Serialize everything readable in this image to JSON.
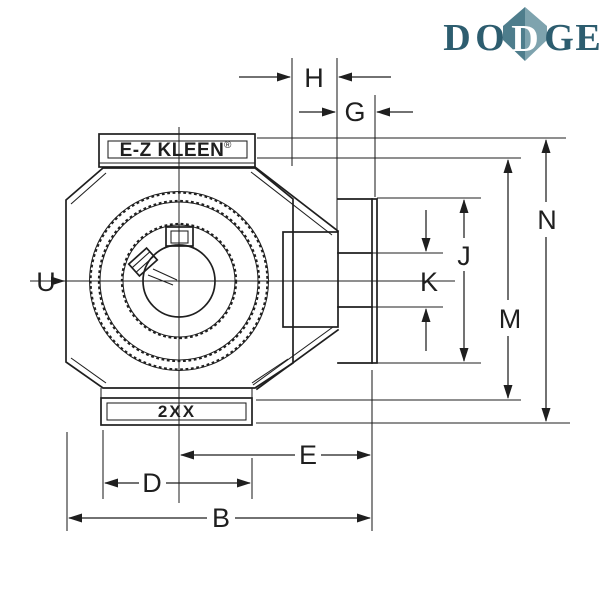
{
  "drawing": {
    "ink": "#1f1f1f",
    "background": "#ffffff",
    "labels": {
      "H": "H",
      "G": "G",
      "N": "N",
      "M": "M",
      "J": "J",
      "K": "K",
      "E": "E",
      "D": "D",
      "B": "B",
      "U": "U"
    },
    "housing_marking": "E-Z KLEEN",
    "housing_marking_reg": "®",
    "base_marking": "2XX"
  },
  "logo": {
    "text": "DODGE",
    "letters": [
      "D",
      "O",
      "D",
      "G",
      "E"
    ],
    "colors": {
      "letters": "#2d5d6f",
      "diamond_dark": "#4e7d8c",
      "diamond_light": "#7ea3ae",
      "diamond_letter": "#ffffff"
    }
  }
}
